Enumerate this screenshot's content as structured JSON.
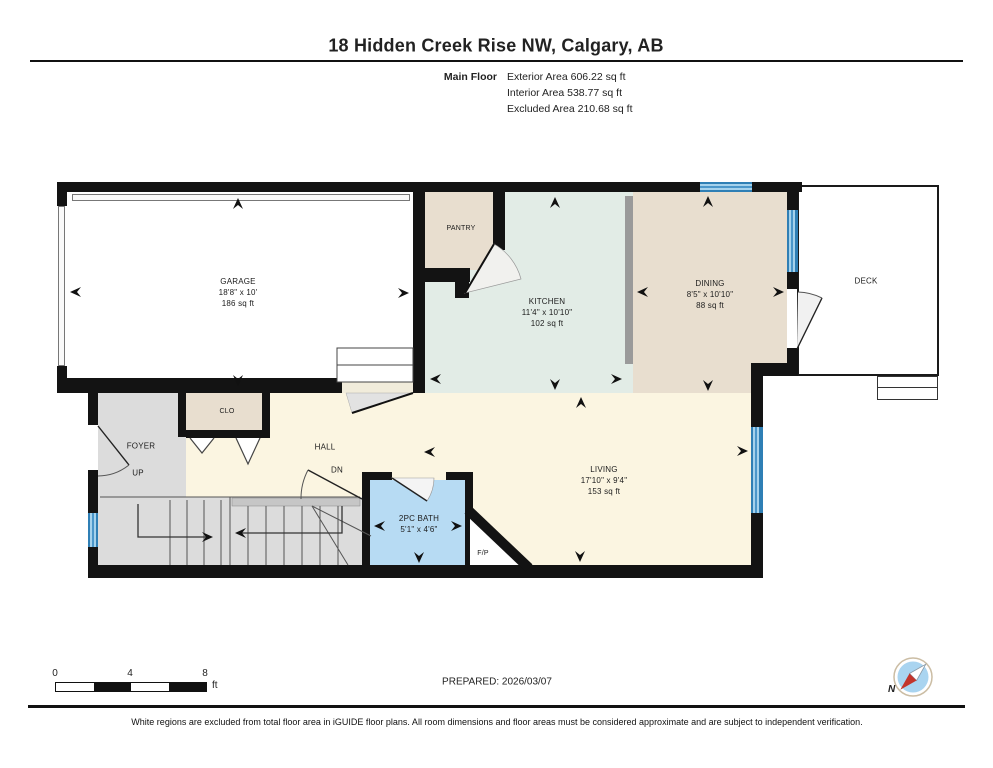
{
  "header": {
    "title": "18 Hidden Creek Rise NW, Calgary, AB",
    "floor_label": "Main Floor",
    "area_lines": [
      "Exterior Area 606.22 sq ft",
      "Interior Area 538.77 sq ft",
      "Excluded Area 210.68 sq ft"
    ]
  },
  "rooms": {
    "garage": {
      "name": "GARAGE",
      "dims": "18'8\" x 10'",
      "area": "186 sq ft"
    },
    "pantry": {
      "name": "PANTRY"
    },
    "kitchen": {
      "name": "KITCHEN",
      "dims": "11'4\" x 10'10\"",
      "area": "102 sq ft"
    },
    "dining": {
      "name": "DINING",
      "dims": "8'5\" x 10'10\"",
      "area": "88 sq ft"
    },
    "deck": {
      "name": "DECK"
    },
    "foyer": {
      "name": "FOYER"
    },
    "closet": {
      "name": "CLO"
    },
    "hall": {
      "name": "HALL"
    },
    "bath": {
      "name": "2PC BATH",
      "dims": "5'1\" x 4'6\""
    },
    "living": {
      "name": "LIVING",
      "dims": "17'10\" x 9'4\"",
      "area": "153 sq ft"
    },
    "fireplace": {
      "name": "F/P"
    }
  },
  "annotations": {
    "up": "UP",
    "down": "DN",
    "north": "N"
  },
  "scale_bar": {
    "tick0": "0",
    "tick1": "4",
    "tick2": "8",
    "unit": "ft"
  },
  "footer": {
    "prepared": "PREPARED: 2026/03/07",
    "disclaimer": "White regions are excluded from total floor area in iGUIDE floor plans. All room dimensions and floor areas must be considered approximate and are subject to independent verification."
  },
  "colors": {
    "wall": "#131313",
    "excluded_white": "#ffffff",
    "hall_living": "#fbf5e1",
    "kitchen": "#e2ece6",
    "dining_beige": "#e8decf",
    "foyer_stairs_gray": "#dcdcdc",
    "bath_blue": "#b7dbf3",
    "window_blue": "#4b97ca",
    "half_wall_gray": "#9a9a9a",
    "compass_red": "#c3342b",
    "compass_blue": "#a9d4f0"
  }
}
